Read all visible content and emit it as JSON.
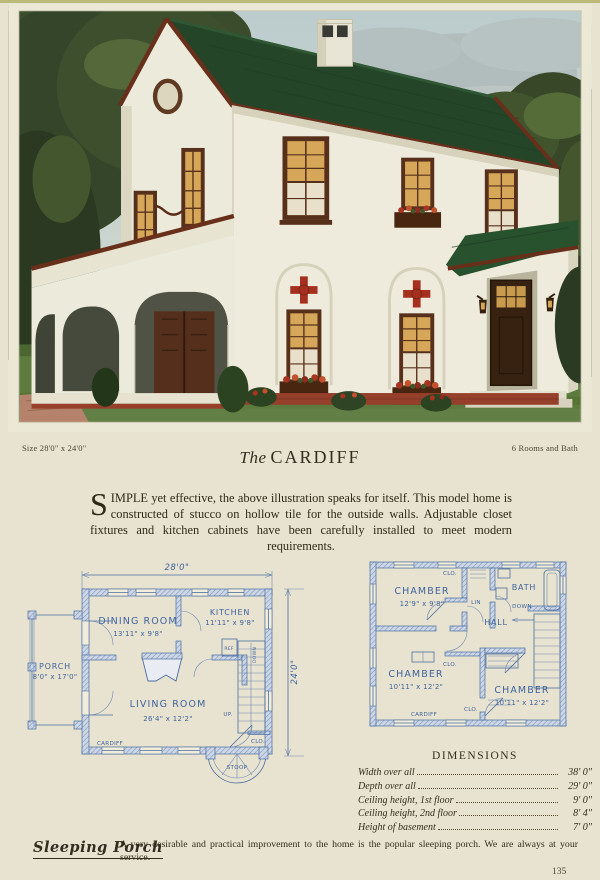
{
  "page": {
    "number": "135",
    "background_color": "#e8e3d0"
  },
  "header": {
    "size_label": "Size 28'0\" x 24'0\"",
    "rooms_label": "6 Rooms and Bath",
    "title_prefix": "The",
    "title_name": "CARDIFF"
  },
  "description": {
    "drop_cap": "S",
    "body": "IMPLE yet effective, the above illustration speaks for itself.  This model home is constructed of stucco on hollow tile for the outside walls.  Adjustable closet fixtures and kitchen cabinets have been carefully installed to meet modern requirements."
  },
  "illustration": {
    "colors": {
      "sky": "#c6d3d0",
      "clouds": "#aeb9ba",
      "trees_dark": "#2c3a23",
      "trees_light": "#4e6233",
      "roof_green": "#254529",
      "trim_maroon": "#68301b",
      "wall_cream": "#efebdc",
      "window_amber": "#d6a758",
      "window_frame": "#57301c",
      "door_brown": "#372111",
      "flower_red": "#a83421",
      "lawn_green": "#5d7b3e",
      "brick_red": "#96402c"
    }
  },
  "first_floor": {
    "width_dim": "28'0\"",
    "depth_dim": "24'0\"",
    "dining_name": "DINING ROOM",
    "dining_size": "13'11\" x 9'8\"",
    "kitchen_name": "KITCHEN",
    "kitchen_size": "11'11\" x 9'8\"",
    "porch_name": "PORCH",
    "porch_size": "8'0\" x 17'0\"",
    "living_name": "LIVING ROOM",
    "living_size": "26'4\" x 12'2\"",
    "ref_label": "REF",
    "down_label": "DOWN",
    "up_label": "UP.",
    "clo_label": "CLO.",
    "cardiff_label": "CARDIFF",
    "stoop_label": "STOOP"
  },
  "second_floor": {
    "chamber1_name": "CHAMBER",
    "chamber1_size": "12'9\" x 9'8\"",
    "chamber2_name": "CHAMBER",
    "chamber2_size": "10'11\" x 12'2\"",
    "chamber3_name": "CHAMBER",
    "chamber3_size": "10'11\" x 12'2\"",
    "bath_label": "BATH",
    "hall_label": "HALL",
    "lin_label": "LIN",
    "down_label": "DOWN",
    "clo_top": "CLO.",
    "clo_mid": "CLO.",
    "clo_bottom": "CLO.",
    "cardiff_label": "CARDIFF"
  },
  "dimensions": {
    "title": "DIMENSIONS",
    "rows": [
      {
        "label": "Width over all",
        "value": "38' 0\""
      },
      {
        "label": "Depth over all",
        "value": "29' 0\""
      },
      {
        "label": "Ceiling height, 1st floor",
        "value": "9' 0\""
      },
      {
        "label": "Ceiling height, 2nd floor",
        "value": "8' 4\""
      },
      {
        "label": "Height of basement",
        "value": "7' 0\""
      }
    ]
  },
  "footer": {
    "heading": "Sleeping Porch",
    "body": "A very desirable and practical improvement to the home is the popular sleeping porch.  We are always at your service."
  }
}
